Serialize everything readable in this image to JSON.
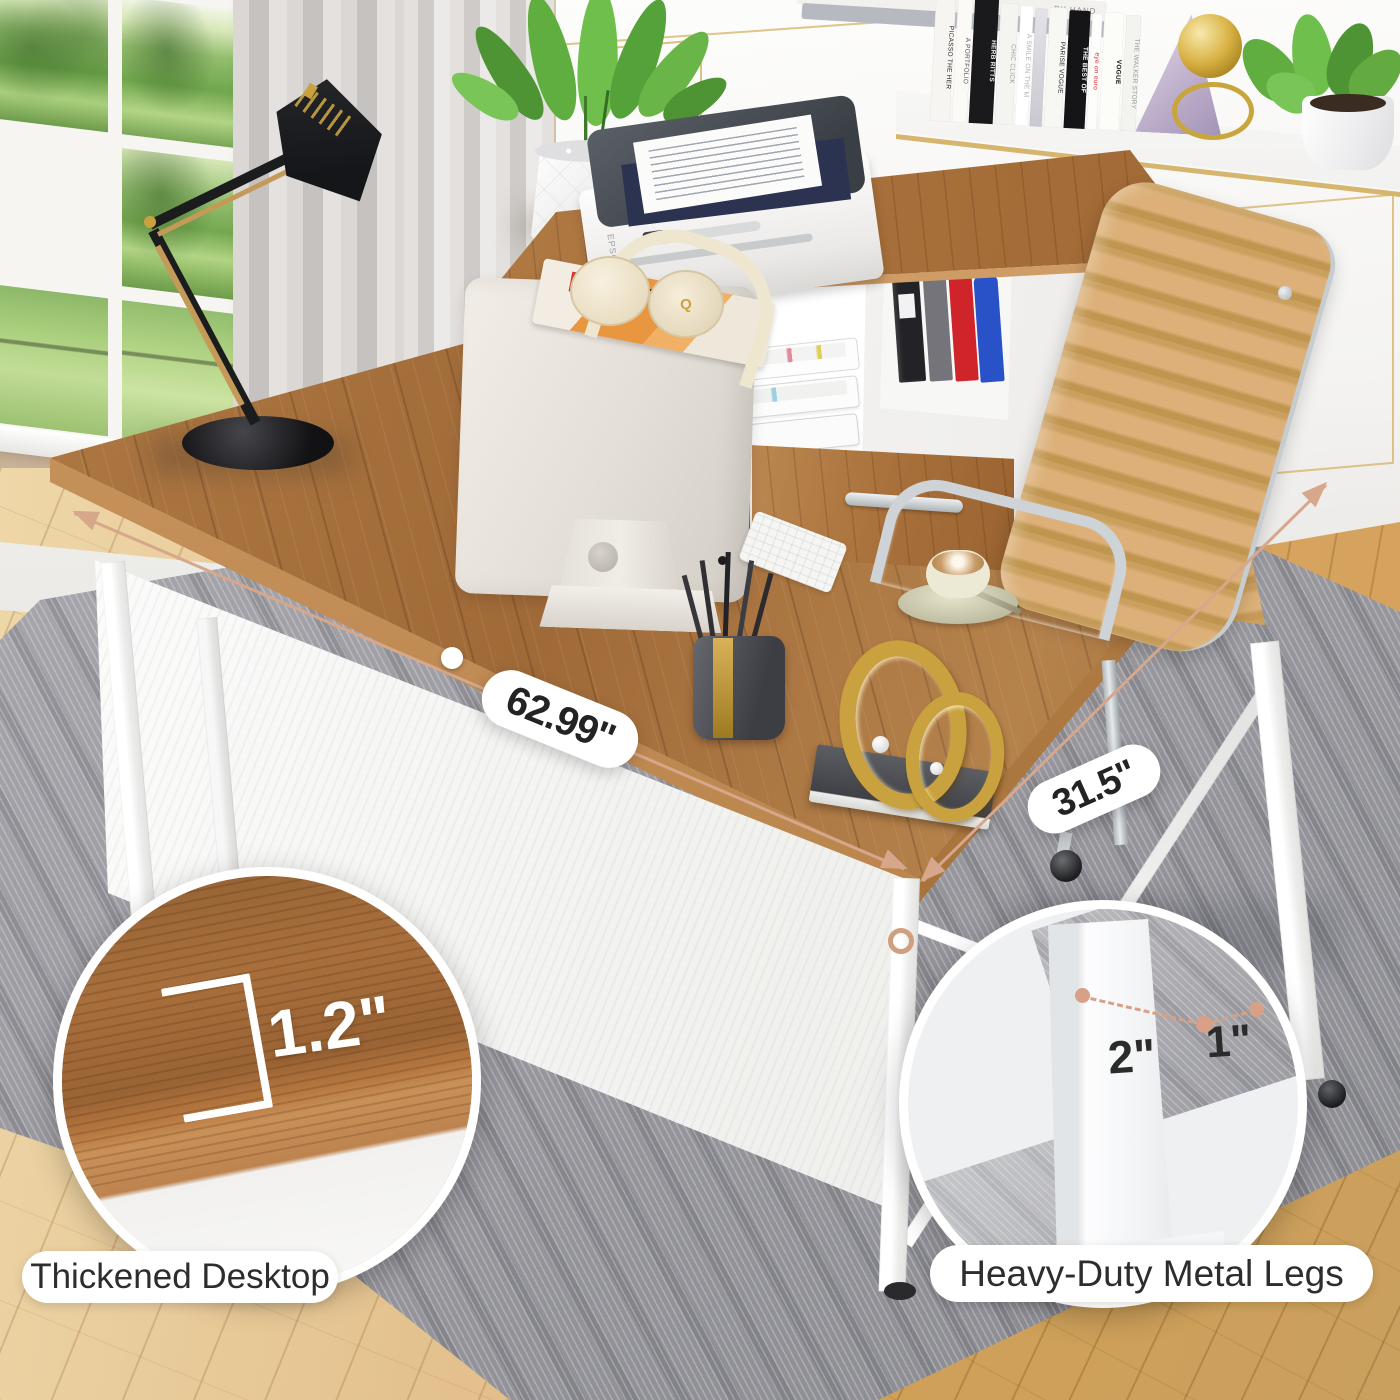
{
  "annotations": {
    "width": {
      "label": "62.99''"
    },
    "depth": {
      "label": "31.5''"
    }
  },
  "callouts": {
    "left": {
      "measurement": "1.2\"",
      "caption": "Thickened Desktop"
    },
    "right": {
      "front_width": "2\"",
      "side_width": "1\"",
      "caption": "Heavy-Duty Metal Legs"
    }
  },
  "desk_items": {
    "printer_brand": "EPSON",
    "headphones_logo": "Q"
  },
  "shelf": {
    "stacked_books_text": "BY HAND",
    "books": [
      {
        "title": "PICASSO THE HER"
      },
      {
        "title": "A PORTFOLIO"
      },
      {
        "title": "HERB RITTS"
      },
      {
        "title": "CHIC CLICK"
      },
      {
        "title": "A SMILE ON THE M"
      },
      {
        "title": ""
      },
      {
        "title": "PARISE VOGUE"
      },
      {
        "title": "THE BEST OF"
      },
      {
        "title": "eye on euro"
      },
      {
        "title": "VOGUE"
      },
      {
        "title": "THE WALKER STORY"
      }
    ]
  },
  "colors": {
    "dimension_accent": "#d7a78c",
    "walnut": "#a9713d",
    "leg_white": "#f5f5f4",
    "rug_gray": "#a2a2a8",
    "leather_tan": "#d8a76e",
    "gold_trim": "#d2b066",
    "label_text": "#2b2b2b"
  }
}
